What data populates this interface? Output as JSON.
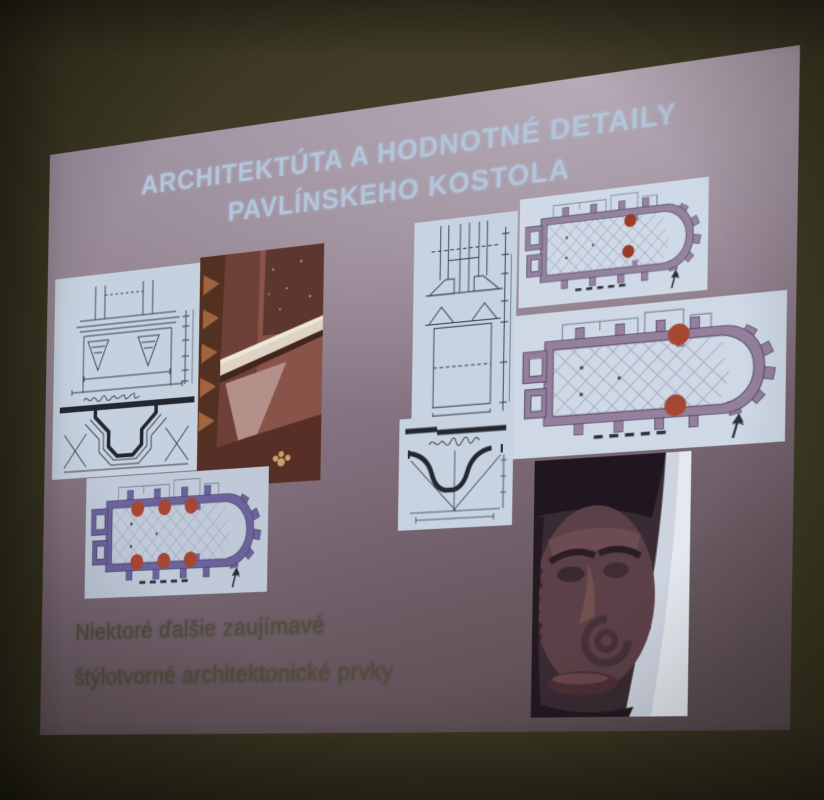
{
  "scene": {
    "kind": "photograph of a projected presentation slide in a dark room",
    "wall_color": "#3d3925"
  },
  "slide": {
    "background_color": "#8b7a88",
    "title": {
      "line1": "ARCHITEKTÚTA A HODNOTNÉ DETAILY",
      "line2": "PAVLÍNSKEHO KOSTOLA",
      "color": "#b3c5da"
    },
    "body": {
      "line1": "Niektoré ďalšie zaujímavé",
      "line2": "štýlotvorné architektonické prvky",
      "color": "#514d3c"
    }
  },
  "figures": [
    {
      "id": "capital-elevation-drawing",
      "kind": "technical drawing",
      "description": "Ink elevation of a pilaster capital with dimension chains and a stepped cornice profile section below"
    },
    {
      "id": "pilaster-base-photo",
      "kind": "photograph",
      "description": "Reddish marble pilaster base with a light moulding band and patterned floor tiles"
    },
    {
      "id": "portal-elevation-drawing",
      "kind": "technical drawing",
      "description": "Ink elevation of a portal jamb with chamfered blocks and dimension chains"
    },
    {
      "id": "moulding-profile-drawing",
      "kind": "technical drawing",
      "description": "Cross-section profile of a cornice moulding with handwritten label"
    },
    {
      "id": "floor-plan-two-markers-small",
      "kind": "floor plan",
      "description": "Church ground plan with two red markers at the triumphal arch",
      "marker_count": 2
    },
    {
      "id": "floor-plan-two-markers-large",
      "kind": "floor plan",
      "description": "Church ground plan with two red markers on the nave walls",
      "marker_count": 2
    },
    {
      "id": "floor-plan-six-markers",
      "kind": "floor plan",
      "description": "Church ground plan with six red markers on the nave pilasters",
      "marker_count": 6
    },
    {
      "id": "mascaron-photo",
      "kind": "photograph",
      "description": "Carved stone mascaron head with volute scroll, photographed detail"
    }
  ],
  "palette": {
    "marker_red": "#a64733",
    "plan_wall_mauve": "#94809c",
    "plan_wall_indigo": "#6b639c",
    "sheet_white": "#cfd9e6",
    "title_blue": "#b3c5da",
    "body_text_olive": "#514d3c",
    "slide_mauve": "#8b7a88",
    "wall_olive": "#3d3925"
  }
}
